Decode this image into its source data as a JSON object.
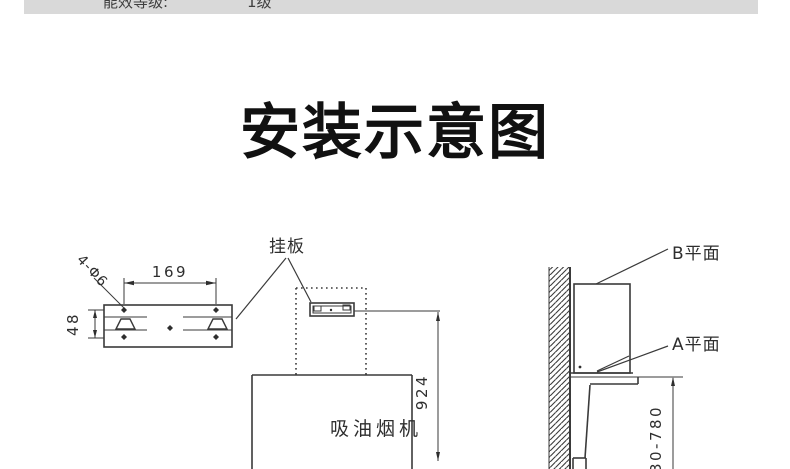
{
  "header": {
    "label": "能效等级:",
    "value": "1级"
  },
  "title": "安装示意图",
  "diagram": {
    "plate": {
      "label": "挂板",
      "dim_width": "169",
      "dim_height": "48",
      "dim_holes": "4-Φ6"
    },
    "hood": {
      "label": "吸油烟机",
      "dim_height": "924"
    },
    "side": {
      "plane_b": "B平面",
      "plane_a": "A平面",
      "dim_height_range": "730-780"
    }
  },
  "colors": {
    "band_bg": "#d9d9d9",
    "line": "#3a3a3a",
    "title": "#111111"
  }
}
